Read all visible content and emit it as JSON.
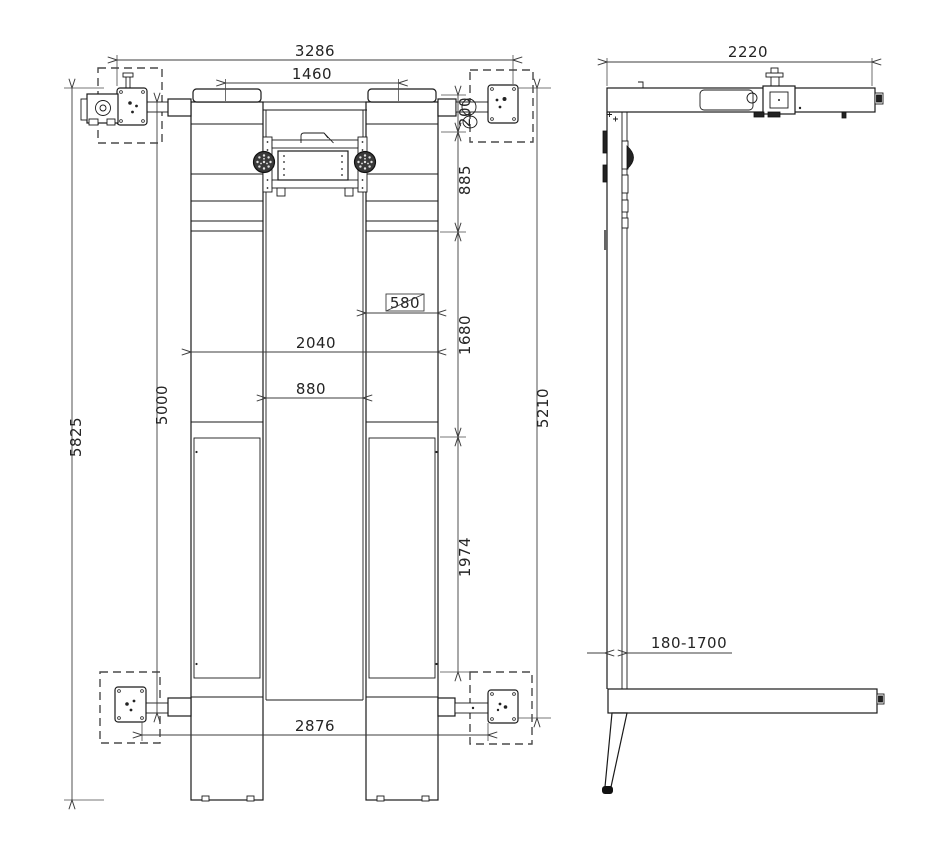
{
  "drawing": {
    "type": "technical-orthographic-drawing",
    "subject": "vehicle parking lift",
    "line_color": "#1a1a1a",
    "dimension_color": "#3d3d3d",
    "background": "#ffffff"
  },
  "dimensions": {
    "plan": {
      "overall_width": "3286",
      "runway_center_spacing": "1460",
      "arm_offset": "200",
      "front_section": "885",
      "runway_width_boxed": "580",
      "platform_outer_width": "2040",
      "platform_inner_gap": "880",
      "mid_section": "1680",
      "drive_length": "5000",
      "overall_length": "5825",
      "frame_length": "5210",
      "rear_section": "1974",
      "base_span": "2876"
    },
    "side": {
      "overall_width": "2220",
      "lift_height_range": "180-1700"
    }
  }
}
